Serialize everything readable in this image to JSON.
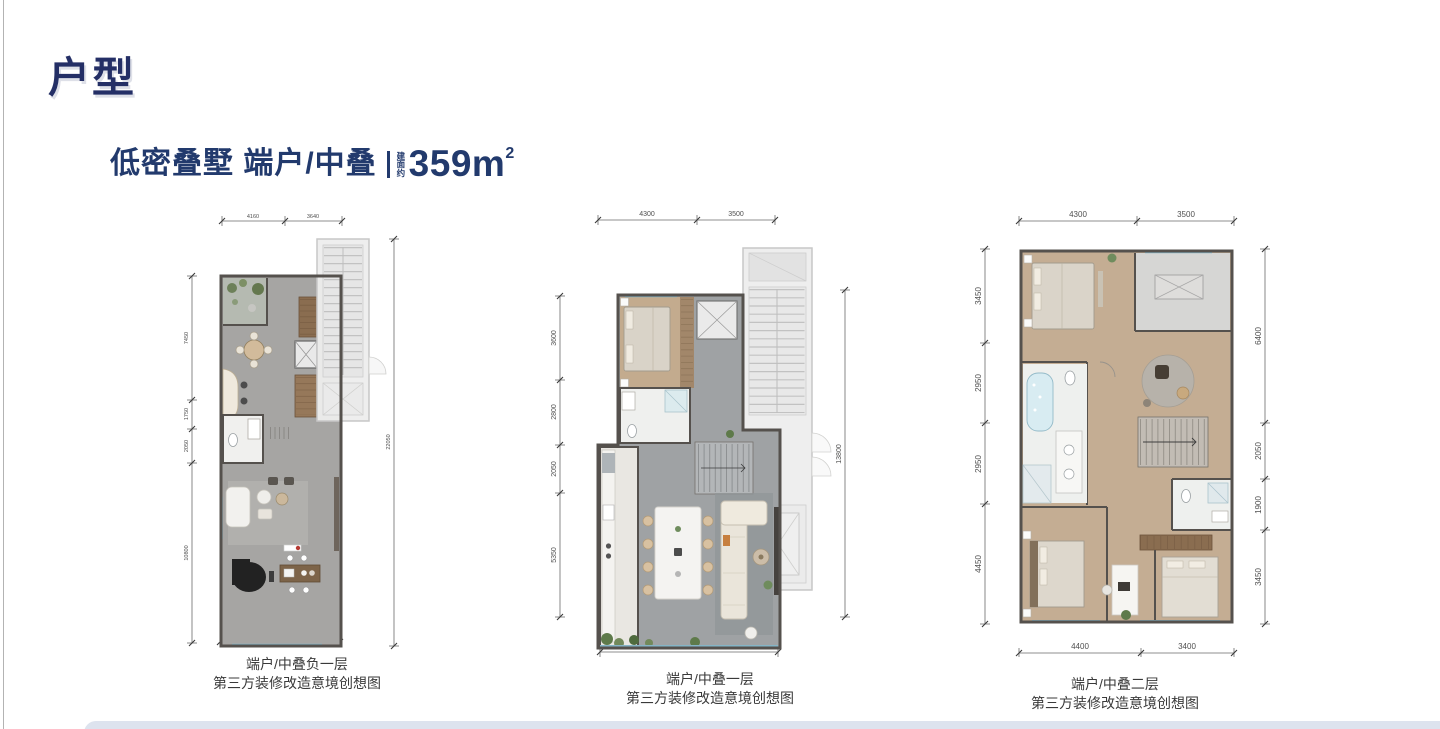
{
  "page": {
    "title": "户型"
  },
  "headline": {
    "main": "低密叠墅 端户/中叠",
    "area_label": "建面约",
    "area_value": "359m",
    "area_sup": "2"
  },
  "plans": [
    {
      "caption": [
        "端户/中叠负一层",
        "第三方装修改造意境创想图"
      ],
      "dims": {
        "top": [
          "4160",
          "3640"
        ],
        "left": [
          "7450",
          "1750",
          "2050",
          "10800"
        ],
        "right": [
          "22050"
        ],
        "bottom": [
          "7800"
        ]
      }
    },
    {
      "caption": [
        "端户/中叠一层",
        "第三方装修改造意境创想图"
      ],
      "dims": {
        "top": [
          "4300",
          "3500"
        ],
        "left": [
          "3600",
          "2800",
          "2050",
          "5350"
        ],
        "right": [
          "13800"
        ],
        "bottom": [
          "7800"
        ]
      }
    },
    {
      "caption": [
        "端户/中叠二层",
        "第三方装修改造意境创想图"
      ],
      "dims": {
        "top": [
          "4300",
          "3500"
        ],
        "left": [
          "3450",
          "2950",
          "2950",
          "4450"
        ],
        "right": [
          "6400",
          "2050",
          "1900",
          "3450"
        ],
        "bottom": [
          "4400",
          "3400"
        ]
      }
    }
  ],
  "colors": {
    "accent_navy": "#223a6d",
    "wall": "#55514d",
    "floor_gray": "#a6a5a3",
    "floor_wood": "#c4ad93",
    "core_gray": "#ededed",
    "glass_teal": "#85b5c6",
    "bottom_bar": "#dde3ee"
  }
}
